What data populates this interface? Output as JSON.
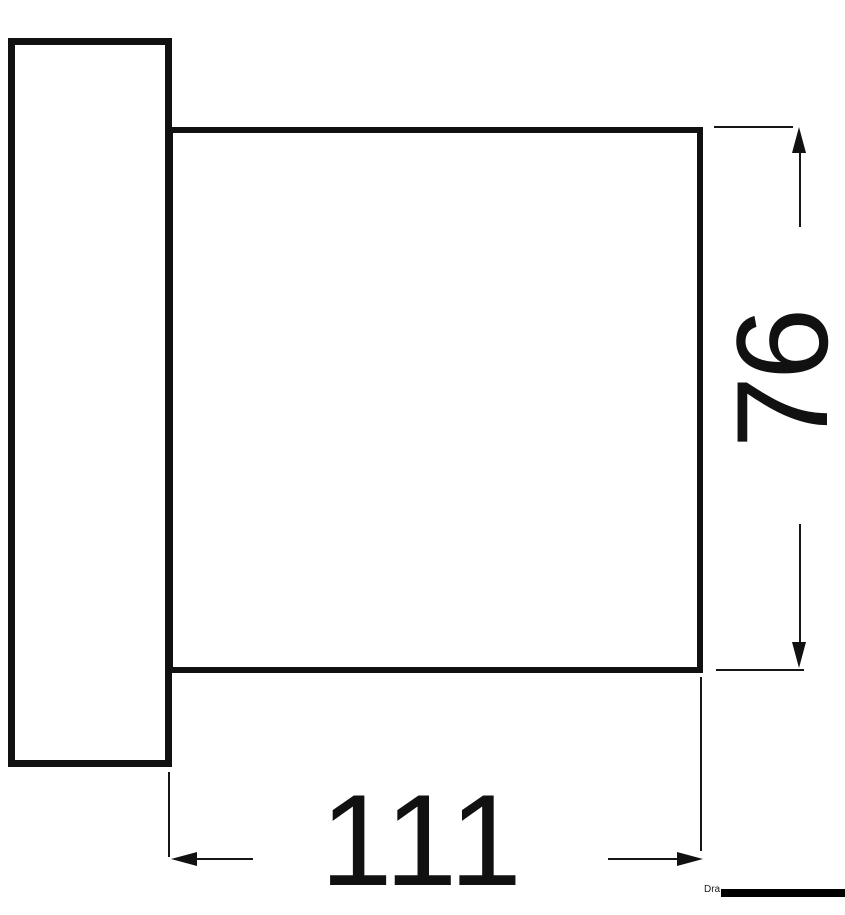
{
  "drawing": {
    "type": "technical-dimension-drawing",
    "view": "side view of flanged square housing",
    "dimensions": {
      "width_label": "111",
      "height_label": "76"
    },
    "footer": {
      "partial_text": "Dra",
      "redacted": true
    },
    "icons": {
      "arrowhead_up": "css-triangle-up",
      "arrowhead_down": "css-triangle-down",
      "arrowhead_left": "css-triangle-left",
      "arrowhead_right": "css-triangle-right"
    },
    "colors": {
      "line": "#111111",
      "background": "#ffffff",
      "redaction_bar": "#000000"
    }
  }
}
